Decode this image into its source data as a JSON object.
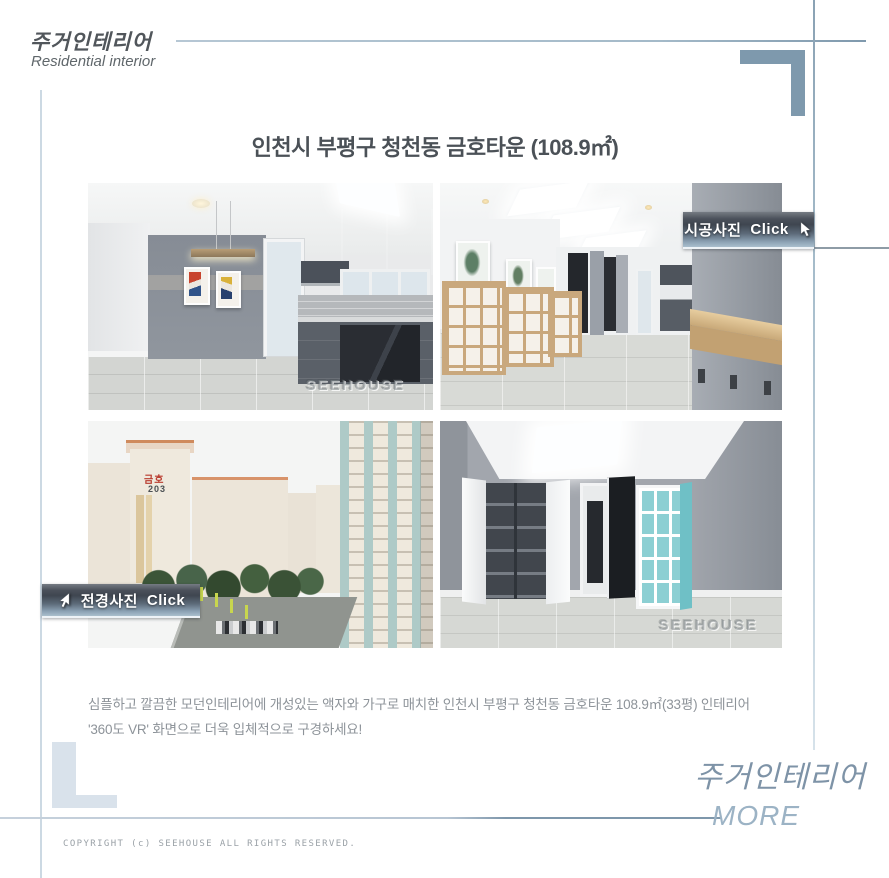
{
  "header": {
    "brand_ko": "주거인테리어",
    "brand_en": "Residential interior"
  },
  "title": "인천시 부평구 청천동 금호타운 (108.9㎡)",
  "gallery": {
    "construction_button": {
      "label": "시공사진",
      "cta": "Click"
    },
    "panorama_button": {
      "label": "전경사진",
      "cta": "Click"
    },
    "watermark": "SEEHOUSE",
    "photos": [
      {
        "name": "kitchen-dining-interior"
      },
      {
        "name": "living-room-interior"
      },
      {
        "name": "apartment-complex-exterior",
        "building_sign": {
          "brand": "금호",
          "number": "203"
        }
      },
      {
        "name": "bedroom-closet-interior"
      }
    ]
  },
  "description": {
    "line1": "심플하고 깔끔한 모던인테리어에 개성있는 액자와 가구로 매치한 인천시 부평구 청천동 금호타운 108.9㎡(33평) 인테리어",
    "line2": "'360도 VR' 화면으로 더욱 입체적으로 구경하세요!"
  },
  "footer": {
    "brand_ko": "주거인테리어",
    "more_label": "MORE",
    "copyright": "COPYRIGHT (c) SEEHOUSE ALL RIGHTS RESERVED."
  },
  "colors": {
    "accent_blue": "#7e99ad",
    "light_blue": "#ccd9e3",
    "button_dark": "#3f4650",
    "button_light": "#aabfcd",
    "teal_shelf": "#8ccfd3",
    "text_dark": "#4b5157",
    "text_gray": "#8d9399"
  }
}
